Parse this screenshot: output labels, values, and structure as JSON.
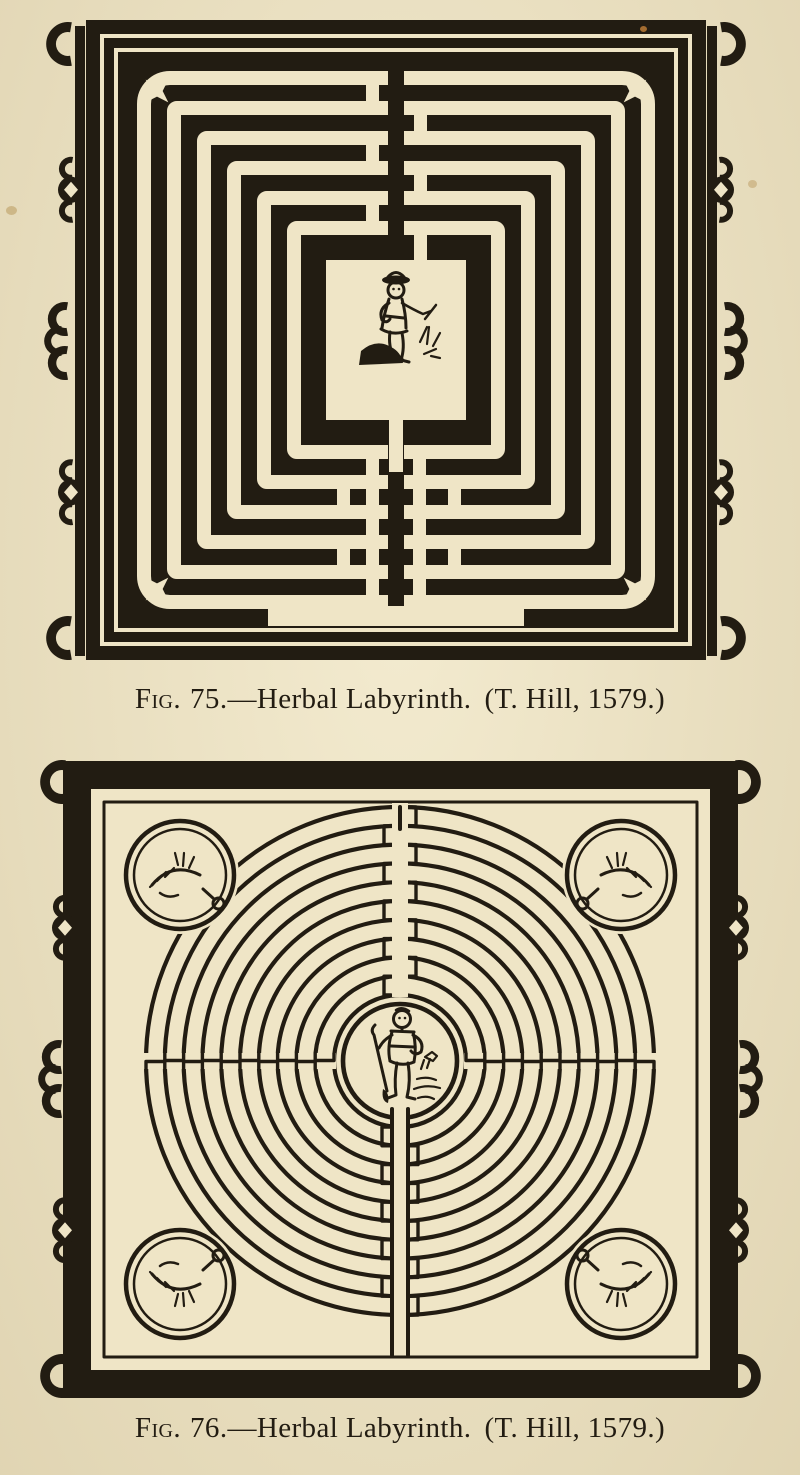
{
  "page": {
    "paper_color": "#efe5c6",
    "ink_color": "#221c12"
  },
  "figures": [
    {
      "label": "Fig.",
      "number": "75.",
      "title": "—Herbal Labyrinth.",
      "source": "(T. Hill, 1579.)"
    },
    {
      "label": "Fig.",
      "number": "76.",
      "title": "—Herbal Labyrinth.",
      "source": "(T. Hill, 1579.)"
    }
  ]
}
